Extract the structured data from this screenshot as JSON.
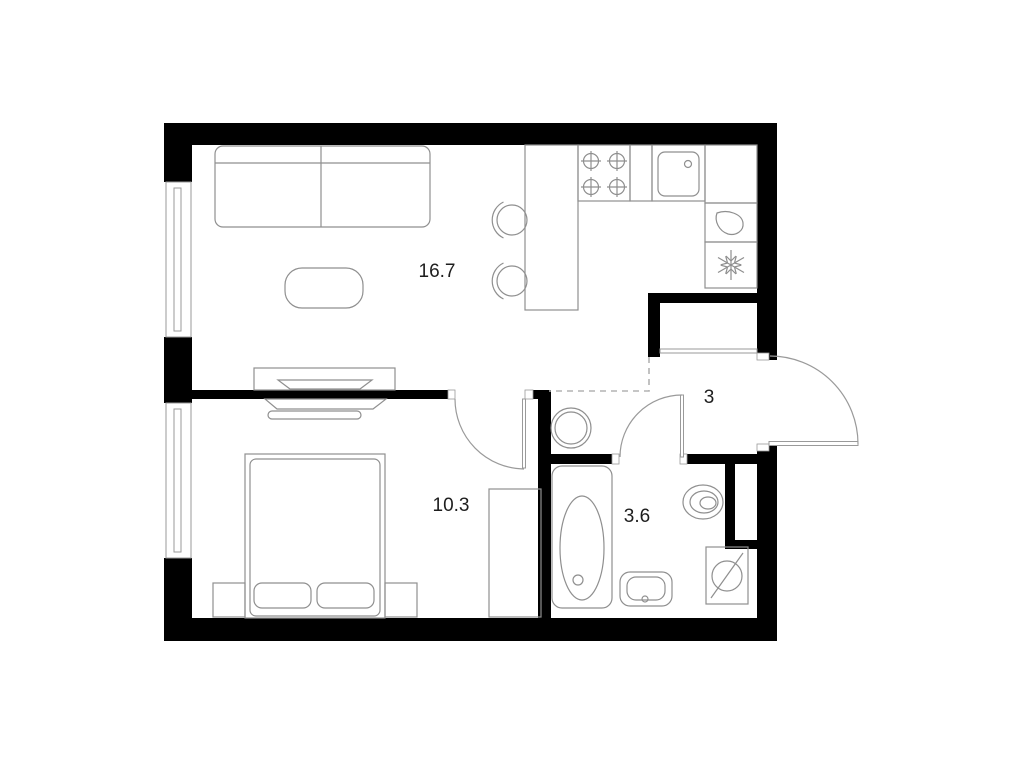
{
  "plan_title": "1-room apartment floor plan",
  "rooms": {
    "living_kitchen": {
      "area_label": "16.7"
    },
    "bedroom": {
      "area_label": "10.3"
    },
    "bathroom": {
      "area_label": "3.6"
    },
    "hallway": {
      "area_label": "3"
    }
  },
  "colors": {
    "wall": "#000000",
    "furniture_line": "#8f8f8f",
    "door_line": "#9a9a9a",
    "dashed_zone_line": "#b3b3b3",
    "label_text": "#1e1e1e",
    "background": "#ffffff"
  },
  "icons": {
    "fridge": "snowflake-icon",
    "water_heater": "water-drop-icon",
    "washing_machine": "circle-slash-icon",
    "stove": "four-burners-icon"
  }
}
